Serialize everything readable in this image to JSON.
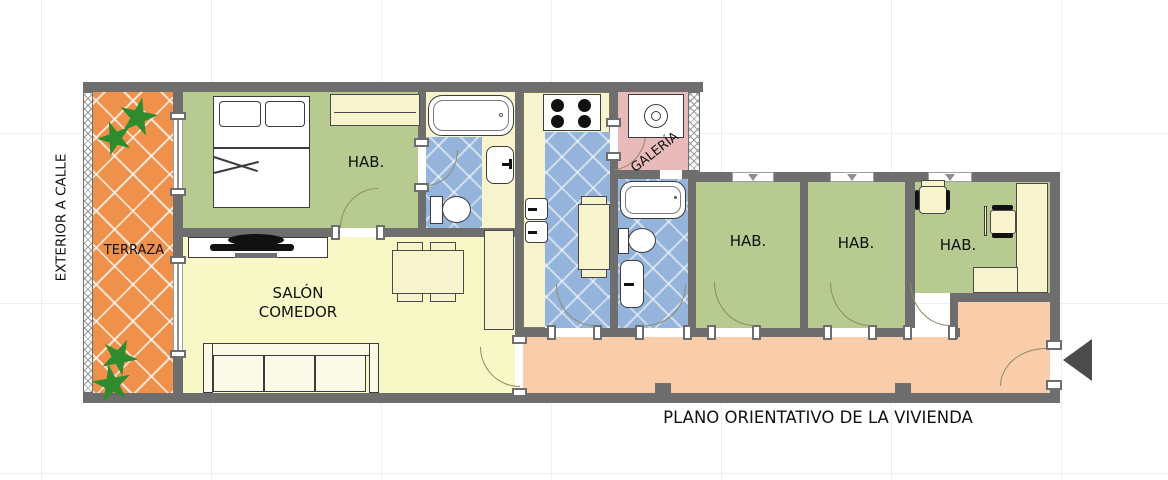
{
  "title": "PLANO ORIENTATIVO DE LA VIVIENDA",
  "side_label": "EXTERIOR A CALLE",
  "labels": {
    "terraza": "TERRAZA",
    "bedroom_main": "HAB.",
    "salon_line1": "SALÓN",
    "salon_line2": "COMEDOR",
    "galeria": "GALERÍA",
    "bedroom2": "HAB.",
    "bedroom3": "HAB.",
    "bedroom4": "HAB."
  },
  "colors": {
    "wall_gray": "#6e6e6e",
    "terrace_orange": "#f0914b",
    "room_green": "#b7ca90",
    "floor_yellow": "#f8f8c6",
    "tile_blue": "#94b4dc",
    "galeria_pink": "#e9baba",
    "corridor_salmon": "#f9cda9",
    "furniture_cream": "#f6f3cd"
  }
}
